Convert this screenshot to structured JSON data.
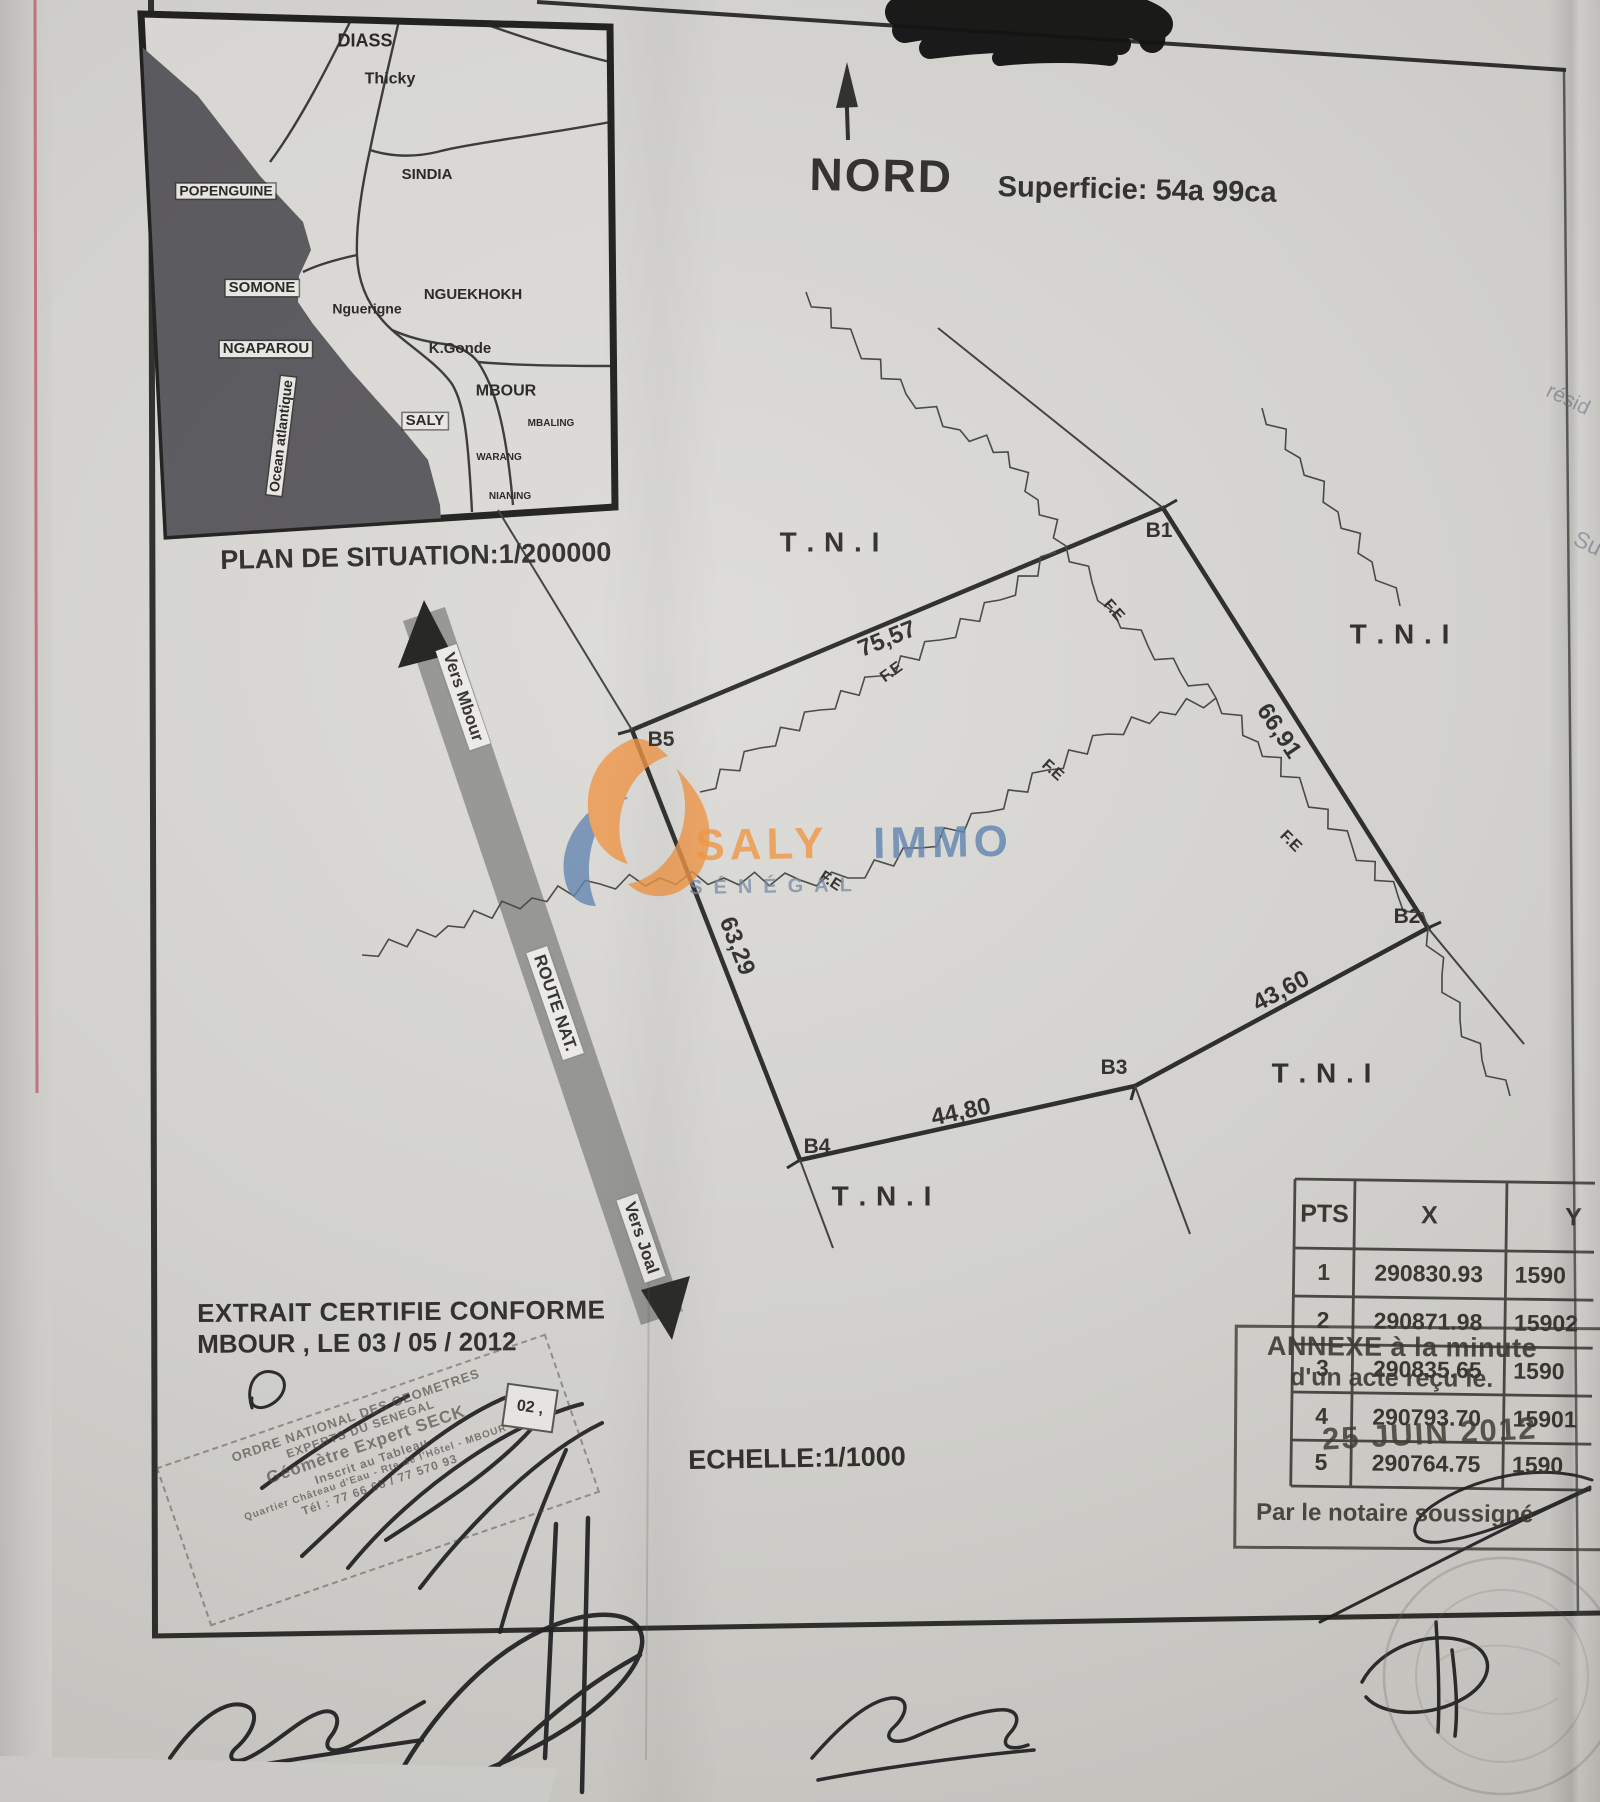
{
  "page": {
    "nord": "NORD",
    "superficie": "Superficie:   54a 99ca",
    "plan_situation": "PLAN DE SITUATION:1/200000",
    "echelle": "ECHELLE:1/1000",
    "extrait_l1": "EXTRAIT CERTIFIE CONFORME",
    "extrait_l2": "MBOUR ,  LE   03   /  05   /   2012",
    "ref_box": "02 ,"
  },
  "inset": {
    "labels": [
      {
        "t": "DIASS",
        "x": 365,
        "y": 41,
        "fs": 18
      },
      {
        "t": "Thicky",
        "x": 390,
        "y": 80,
        "fs": 16
      },
      {
        "t": "SINDIA",
        "x": 427,
        "y": 175,
        "fs": 15
      },
      {
        "t": "POPENGUINE",
        "x": 226,
        "y": 191,
        "fs": 14,
        "bx": 1
      },
      {
        "t": "SOMONE",
        "x": 262,
        "y": 288,
        "fs": 15,
        "bx": 1
      },
      {
        "t": "NGUEKHOKH",
        "x": 473,
        "y": 295,
        "fs": 15
      },
      {
        "t": "Nguerigne",
        "x": 367,
        "y": 309,
        "fs": 14
      },
      {
        "t": "NGAPAROU",
        "x": 266,
        "y": 349,
        "fs": 15,
        "bx": 1
      },
      {
        "t": "K.Gonde",
        "x": 460,
        "y": 349,
        "fs": 15
      },
      {
        "t": "MBOUR",
        "x": 506,
        "y": 392,
        "fs": 16
      },
      {
        "t": "SALY",
        "x": 425,
        "y": 421,
        "fs": 15,
        "bx": 1
      },
      {
        "t": "MBALING",
        "x": 551,
        "y": 424,
        "fs": 10
      },
      {
        "t": "WARANG",
        "x": 499,
        "y": 458,
        "fs": 10
      },
      {
        "t": "NIANING",
        "x": 510,
        "y": 497,
        "fs": 10
      },
      {
        "t": "Ocean atlantique",
        "x": 281,
        "y": 436,
        "fs": 14,
        "bx": 1,
        "rot": -83
      }
    ]
  },
  "parcel": {
    "tni_text": "T . N . I",
    "fe_text": "F.E",
    "vertices": [
      {
        "t": "B1",
        "x": 1159,
        "y": 531
      },
      {
        "t": "B2",
        "x": 1407,
        "y": 917
      },
      {
        "t": "B3",
        "x": 1114,
        "y": 1068
      },
      {
        "t": "B4",
        "x": 817,
        "y": 1147
      },
      {
        "t": "B5",
        "x": 661,
        "y": 740
      }
    ],
    "lengths": [
      {
        "t": "75,57",
        "x": 887,
        "y": 639,
        "rot": -22
      },
      {
        "t": "66,91",
        "x": 1279,
        "y": 731,
        "rot": 56
      },
      {
        "t": "43,60",
        "x": 1281,
        "y": 991,
        "rot": -28
      },
      {
        "t": "44,80",
        "x": 961,
        "y": 1112,
        "rot": -12
      },
      {
        "t": "63,29",
        "x": 737,
        "y": 946,
        "rot": 69
      }
    ],
    "tni": [
      {
        "x": 830,
        "y": 542
      },
      {
        "x": 1400,
        "y": 634
      },
      {
        "x": 1322,
        "y": 1073
      },
      {
        "x": 882,
        "y": 1196
      }
    ],
    "fe": [
      {
        "x": 1113,
        "y": 611,
        "rot": 48
      },
      {
        "x": 1290,
        "y": 842,
        "rot": 45
      },
      {
        "x": 830,
        "y": 882,
        "rot": 33
      },
      {
        "x": 1052,
        "y": 771,
        "rot": 42
      },
      {
        "x": 892,
        "y": 673,
        "rot": -36
      }
    ]
  },
  "road": {
    "vers_mbour": "Vers Mbour",
    "route_nat": "ROUTE NAT.",
    "vers_joal": "Vers Joal"
  },
  "logo": {
    "word1": "SALY",
    "word2": "IMMO",
    "sub": "SÉNÉGAL"
  },
  "table": {
    "col_pts": "PTS",
    "col_x": "X",
    "col_y": "Y",
    "rows": [
      [
        "1",
        "290830.93",
        "1590"
      ],
      [
        "2",
        "290871.98",
        "15902"
      ],
      [
        "3",
        "290835.65",
        "1590"
      ],
      [
        "4",
        "290793.70",
        "15901"
      ],
      [
        "5",
        "290764.75",
        "1590"
      ]
    ]
  },
  "annexe": {
    "l1": "ANNEXE à la minute",
    "l2": "d'un acte reçu le.",
    "date": "25 JUIN 2012",
    "sig": "Par le notaire soussigné"
  },
  "stamp": {
    "lines": [
      {
        "t": "ORDRE NATIONAL DES GEOMETRES",
        "fs": 13
      },
      {
        "t": "EXPERTS DU SENEGAL",
        "fs": 12
      },
      {
        "t": "Géomètre Expert   SECK",
        "fs": 17
      },
      {
        "t": "Inscrit au Tableau",
        "fs": 12
      },
      {
        "t": "Quartier Château d'Eau - Rte de l'Hôtel - MBOUR",
        "fs": 10
      },
      {
        "t": "Tél : 77 66 65 / 77 570 93",
        "fs": 12
      }
    ]
  },
  "notes": {
    "n1": "résid",
    "n2": "Su"
  }
}
